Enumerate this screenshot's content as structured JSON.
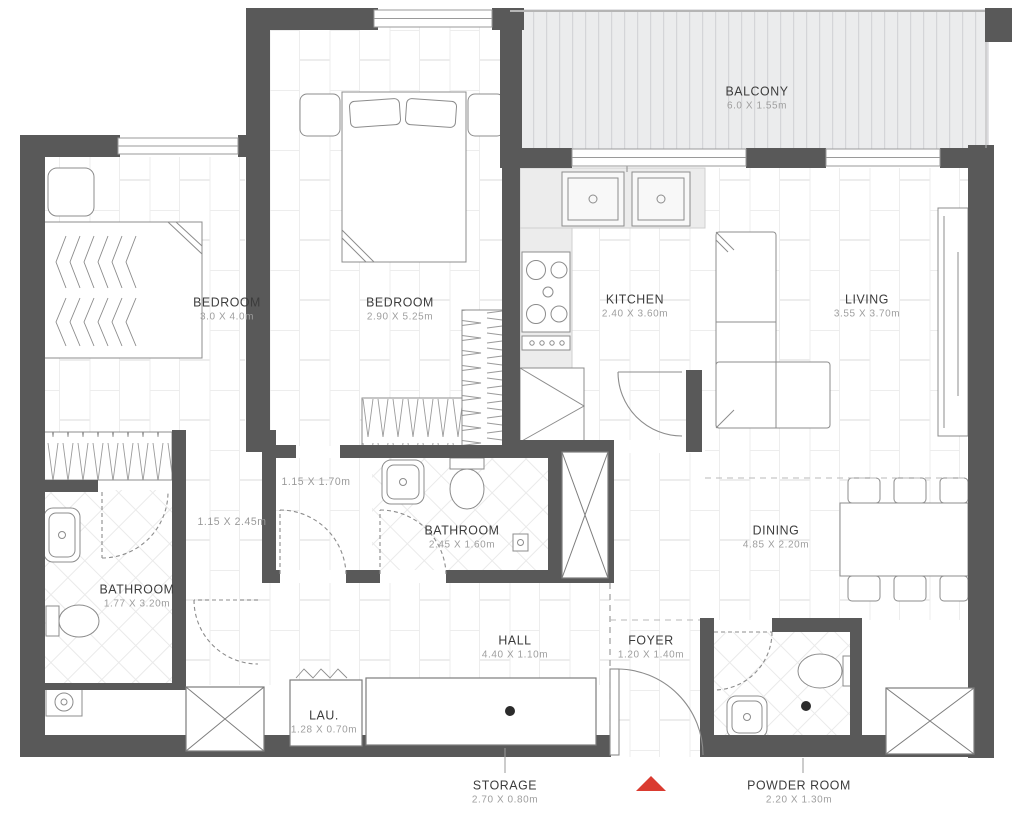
{
  "plan": {
    "rooms": [
      {
        "name": "BALCONY",
        "dims": "6.0 X 1.55m"
      },
      {
        "name": "BEDROOM",
        "dims": "3.0 X 4.0m"
      },
      {
        "name": "BEDROOM",
        "dims": "2.90 X 5.25m"
      },
      {
        "name": "KITCHEN",
        "dims": "2.40 X 3.60m"
      },
      {
        "name": "LIVING",
        "dims": "3.55 X 3.70m"
      },
      {
        "name": "BATHROOM",
        "dims": "2.45 X 1.60m"
      },
      {
        "name": "BATHROOM",
        "dims": "1.77 X 3.20m"
      },
      {
        "name": "DINING",
        "dims": "4.85 X 2.20m"
      },
      {
        "name": "HALL",
        "dims": "4.40 X 1.10m"
      },
      {
        "name": "FOYER",
        "dims": "1.20 X 1.40m"
      },
      {
        "name": "LAU.",
        "dims": "1.28 X 0.70m"
      },
      {
        "name": "STORAGE",
        "dims": "2.70 X 0.80m"
      },
      {
        "name": "POWDER ROOM",
        "dims": "2.20 X 1.30m"
      }
    ],
    "annotations": [
      {
        "dims": "1.15 X 1.70m"
      },
      {
        "dims": "1.15 X 2.45m"
      }
    ],
    "markers": [
      {
        "name": "entrance-marker",
        "color": "#da3b30"
      }
    ],
    "colors": {
      "wall": "#595959",
      "balcony_floor": "#ebeced",
      "balcony_stripe": "#d4d5d8",
      "tile_line": "#ededed",
      "furniture_stroke": "#8c8c8c",
      "room_name_text": "#3c3c3c",
      "dims_text": "#9e9e9e",
      "entrance_red": "#da3b30"
    }
  }
}
